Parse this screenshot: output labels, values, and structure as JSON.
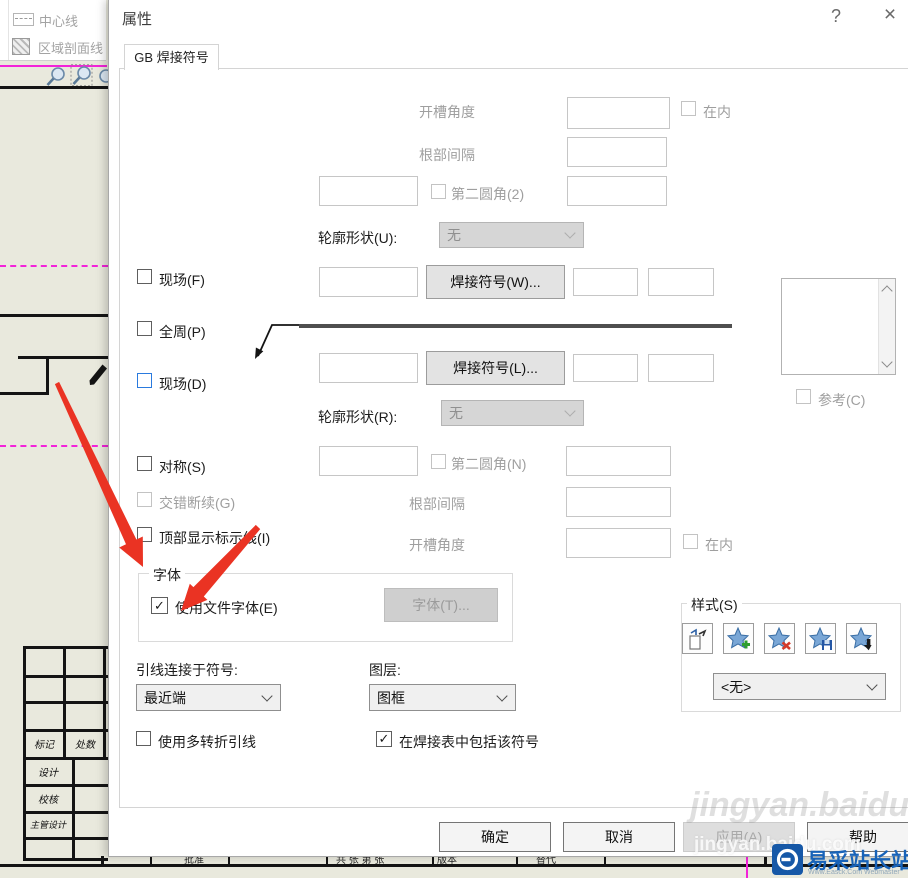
{
  "icons": {
    "check": "✓",
    "help": "?",
    "close": "×"
  },
  "window": {
    "title": "属性",
    "tab": "GB 焊接符号"
  },
  "labels": {
    "groove_angle_top": "开槽角度",
    "root_gap_top": "根部间隔",
    "second_fillet_2": "第二圆角(2)",
    "contour_u": "轮廓形状(U):",
    "contour_u_value": "无",
    "field_f": "现场(F)",
    "weld_symbol_w": "焊接符号(W)...",
    "all_around_p": "全周(P)",
    "field_d": "现场(D)",
    "weld_symbol_l": "焊接符号(L)...",
    "contour_r": "轮廓形状(R):",
    "contour_r_value": "无",
    "symmetric_s": "对称(S)",
    "second_fillet_n": "第二圆角(N)",
    "stagger_g": "交错断续(G)",
    "root_gap_bottom": "根部间隔",
    "top_id_line_i": "顶部显示标示线(I)",
    "groove_angle_bottom": "开槽角度",
    "inside_top": "在内",
    "inside_bottom": "在内",
    "reference_c": "参考(C)",
    "font_group": "字体",
    "use_document_font": "使用文件字体(E)",
    "font_button": "字体(T)...",
    "leader_anchor": "引线连接于符号:",
    "leader_anchor_value": "最近端",
    "layer": "图层:",
    "layer_value": "图框",
    "multi_jog_leader": "使用多转折引线",
    "include_in_weld_table": "在焊接表中包括该符号",
    "style_group": "样式(S)",
    "style_value": "<无>"
  },
  "buttons": {
    "ok": "确定",
    "cancel": "取消",
    "apply": "应用(A)",
    "help": "帮助"
  },
  "background": {
    "menu": [
      "中心线",
      "区域剖面线"
    ],
    "title_block": [
      "标记",
      "处数",
      "设计",
      "校核",
      "主管设计"
    ],
    "bottom_row": [
      "批准",
      "共 张 第 张",
      "版本",
      "替代"
    ]
  },
  "watermark": {
    "overlay_text": "jingyan.baidu.com",
    "site_name": "易采站长站",
    "site_subtitle": "Www.Easck.Com Webmaster"
  }
}
